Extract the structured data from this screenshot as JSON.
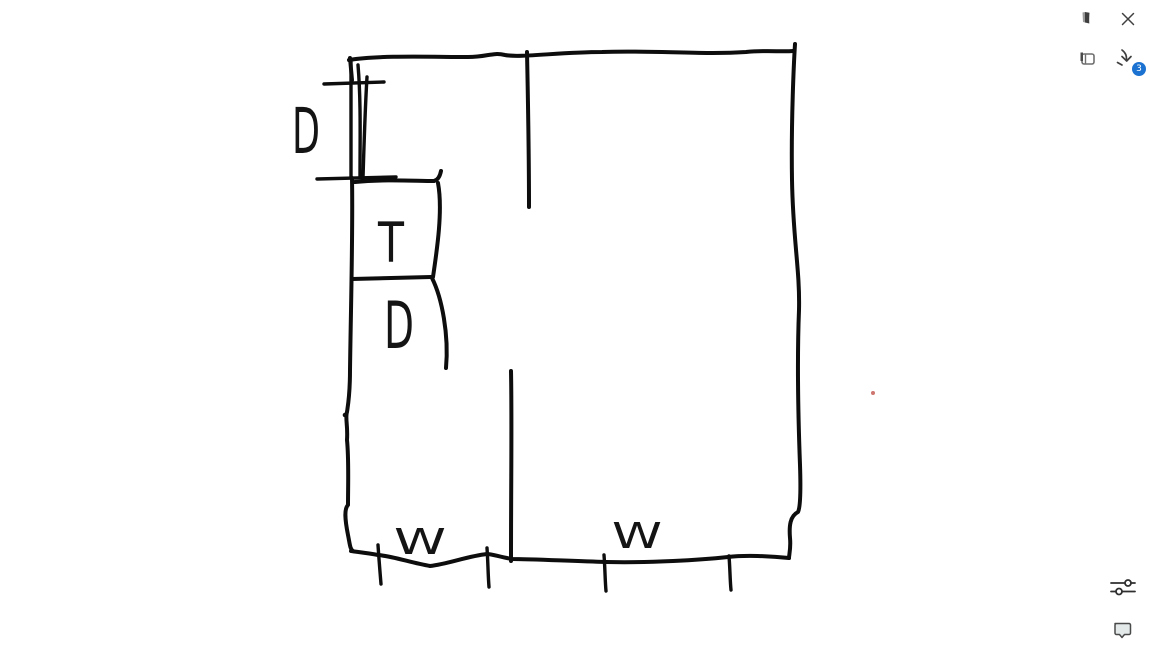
{
  "window": {
    "background": "#ffffff",
    "ink_color": "#0d0d0d",
    "icon_color": "#3f3f3f"
  },
  "top_right": {
    "icons": [
      {
        "name": "journal-page-icon"
      },
      {
        "name": "close-icon"
      },
      {
        "name": "notebook-icon"
      },
      {
        "name": "inbox-download-icon"
      }
    ],
    "inbox_badge": {
      "count": "3",
      "color": "#1b72d0"
    }
  },
  "bottom_right": {
    "icons": [
      {
        "name": "filter-sliders-icon"
      },
      {
        "name": "feedback-bubble-icon"
      }
    ]
  },
  "sketch": {
    "labels": {
      "door_top": "D",
      "room_t": "T",
      "door_inner": "D",
      "window_left": "W",
      "window_right": "W"
    },
    "accents": {
      "red_dot_color": "#c0524a"
    }
  }
}
